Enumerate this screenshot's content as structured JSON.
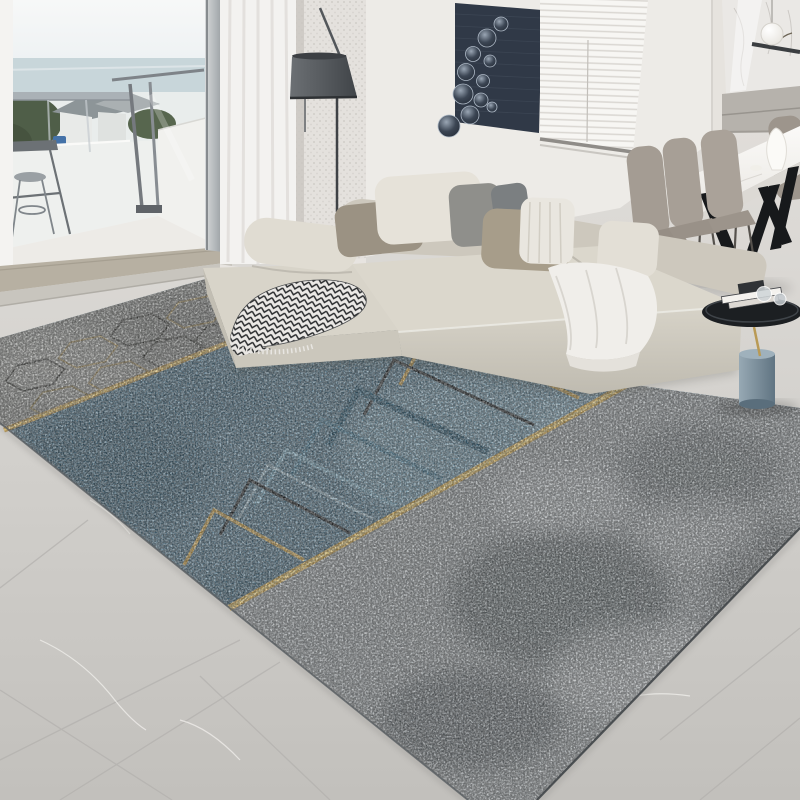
{
  "scene": {
    "type": "interior-photograph",
    "description": "Modern living room with L-shaped cream sectional sofa, balcony with bar table, floor lamp, bubble wall art, venetian blinds, marble dining table with taupe chairs, round side table, and a large abstract blue-grey area rug with gold diagonal lines, nested chevrons and a hexagon band on grey marble tile floor"
  },
  "palette": {
    "wall": "#edebe7",
    "wallShade": "#e3e0db",
    "floorLight": "#dedcd8",
    "floorDark": "#c5c3bf",
    "thresholdWood": "#b7b0a2",
    "thresholdStep": "#c8c5be",
    "jamb": "#a7abae",
    "curtain": "#f3f2f0",
    "curtainLace": "#dcd9d5",
    "lampShade": "#585c60",
    "artPanel": "#303947",
    "blinds": "#f6f5f2",
    "marblePanel": "#eae8e5",
    "cabinet": "#b6b2ac",
    "tableTop": "#f5f3f0",
    "tableLeg": "#17191b",
    "chair": "#a49c93",
    "sofaCream": "#dbd7cc",
    "sofaFront": "#cdc9be",
    "sofaBack": "#cdc8bd",
    "ottoman": "#d8d4c9",
    "rugBlue": "#53768a",
    "rugBlueDark": "#2d5166",
    "rugBlueLight": "#8cb0c0",
    "rugGray": "#9ba1a4",
    "rugGrayDark": "#4a5257",
    "hexBand": "#90928f",
    "gold": "#c9a24b",
    "goldBright": "#e8c86f",
    "chevronBlack": "#24282b",
    "throwHerringbone": "#2a2c2e",
    "throwWhite": "#f0eeea",
    "sideTableTop": "#1c1f22",
    "cylinderBlue": "#7e93a0",
    "greenery": "#4f5e48",
    "sea": "#c8d6da",
    "sky": "#f5f7f7",
    "car": "#4472a8"
  },
  "objects": [
    "balcony-view",
    "balcony-bar-table",
    "balcony-stool",
    "railing",
    "sliding-door-frame",
    "sheer-curtain",
    "floor-lamp",
    "bubble-wall-art",
    "venetian-blinds",
    "kitchen-marble-wall",
    "pendant-lamp",
    "kitchen-cabinet",
    "dining-table",
    "dining-chairs",
    "white-vase",
    "sectional-sofa",
    "back-pillows",
    "herringbone-throw",
    "white-throw",
    "round-side-table",
    "decor-books",
    "area-rug",
    "hexagon-band",
    "gold-lines",
    "chevron-pattern",
    "marble-tile-floor"
  ]
}
